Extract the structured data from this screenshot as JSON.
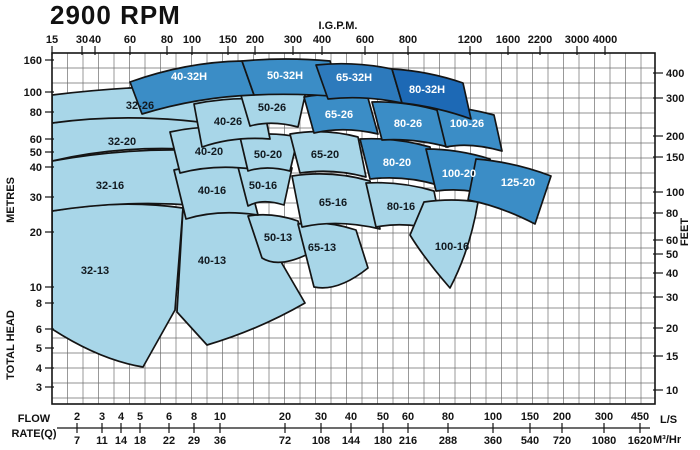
{
  "title": "2900 RPM",
  "colors": {
    "light": "#a8d6e8",
    "medium": "#3b8dc6",
    "dark": "#2d7abc",
    "darkest": "#1d69b5",
    "label_on_light": "#121a20",
    "label_on_dark": "#ffffff",
    "grid": "#6e6e6e",
    "axis": "#141414"
  },
  "axes": {
    "top": {
      "title": "I.G.P.M.",
      "ticks": [
        [
          "15",
          52
        ],
        [
          "30",
          82
        ],
        [
          "40",
          95
        ],
        [
          "60",
          130
        ],
        [
          "80",
          167
        ],
        [
          "100",
          192
        ],
        [
          "150",
          228
        ],
        [
          "200",
          255
        ],
        [
          "300",
          293
        ],
        [
          "400",
          322
        ],
        [
          "600",
          365
        ],
        [
          "800",
          408
        ],
        [
          "1200",
          470
        ],
        [
          "1600",
          508
        ],
        [
          "2200",
          540
        ],
        [
          "3000",
          577
        ],
        [
          "4000",
          605
        ]
      ]
    },
    "left": {
      "title": "METRES",
      "title2": "TOTAL HEAD",
      "ticks": [
        [
          "160",
          60
        ],
        [
          "100",
          92
        ],
        [
          "80",
          112
        ],
        [
          "60",
          139
        ],
        [
          "50",
          152
        ],
        [
          "40",
          167
        ],
        [
          "30",
          197
        ],
        [
          "20",
          232
        ],
        [
          "10",
          287
        ],
        [
          "8",
          303
        ],
        [
          "6",
          329
        ],
        [
          "5",
          348
        ],
        [
          "4",
          368
        ],
        [
          "3",
          387
        ]
      ]
    },
    "right": {
      "title": "FEET",
      "ticks": [
        [
          "400",
          73
        ],
        [
          "300",
          98
        ],
        [
          "200",
          136
        ],
        [
          "150",
          157
        ],
        [
          "100",
          192
        ],
        [
          "80",
          213
        ],
        [
          "60",
          240
        ],
        [
          "50",
          254
        ],
        [
          "40",
          273
        ],
        [
          "30",
          297
        ],
        [
          "20",
          328
        ],
        [
          "15",
          356
        ],
        [
          "10",
          390
        ]
      ]
    },
    "bottom": {
      "title_line1": "FLOW",
      "title_line2": "RATE(Q)",
      "unit1": "L/S",
      "unit2": "M³/Hr",
      "ticks": [
        [
          77,
          "2",
          "7"
        ],
        [
          102,
          "3",
          "11"
        ],
        [
          121,
          "4",
          "14"
        ],
        [
          140,
          "5",
          "18"
        ],
        [
          169,
          "6",
          "22"
        ],
        [
          194,
          "8",
          "29"
        ],
        [
          220,
          "10",
          "36"
        ],
        [
          285,
          "20",
          "72"
        ],
        [
          321,
          "30",
          "108"
        ],
        [
          351,
          "40",
          "144"
        ],
        [
          383,
          "50",
          "180"
        ],
        [
          408,
          "60",
          "216"
        ],
        [
          448,
          "80",
          "288"
        ],
        [
          493,
          "100",
          "360"
        ],
        [
          530,
          "150",
          "540"
        ],
        [
          562,
          "200",
          "720"
        ],
        [
          604,
          "300",
          "1080"
        ],
        [
          640,
          "450",
          "1620"
        ]
      ]
    }
  },
  "chart_data": {
    "type": "pump-selection-chart",
    "rpm": "2900 RPM",
    "x_units": [
      "I.G.P.M.",
      "L/S",
      "M³/Hr"
    ],
    "y_units": [
      "METRES",
      "FEET"
    ],
    "plot": {
      "x0": 52,
      "y0": 53,
      "x1": 655,
      "y1": 404,
      "grid_step_x": 15.5,
      "grid_step_y": 15
    },
    "regions": [
      {
        "label": "32-13",
        "tone": "light",
        "path": "M52,211 Q120,199 183,208 L175,310 143,367 Q100,360 52,329 Z",
        "lx": 95,
        "ly": 274
      },
      {
        "label": "40-13",
        "tone": "light",
        "path": "M183,208 Q218,202 252,212 L305,303 Q258,330 207,345 L177,312 Z",
        "lx": 212,
        "ly": 264
      },
      {
        "label": "50-13",
        "tone": "light",
        "path": "M248,216 Q272,212 298,221 L306,255 Q278,268 262,258 Z",
        "lx": 278,
        "ly": 241
      },
      {
        "label": "65-13",
        "tone": "light",
        "path": "M298,224 Q326,220 356,230 L368,268 Q338,292 314,287 Z",
        "lx": 322,
        "ly": 251
      },
      {
        "label": "32-16",
        "tone": "light",
        "path": "M52,161 Q140,145 228,152 L244,211 Q148,196 52,211 Z",
        "lx": 110,
        "ly": 189
      },
      {
        "label": "40-16",
        "tone": "light",
        "path": "M174,170 Q210,162 246,169 L258,215 Q218,209 186,219 Z",
        "lx": 212,
        "ly": 194
      },
      {
        "label": "50-16",
        "tone": "light",
        "path": "M238,167 Q264,161 292,168 L284,205 Q262,198 248,206 Z",
        "lx": 263,
        "ly": 189
      },
      {
        "label": "65-16",
        "tone": "light",
        "path": "M292,176 Q332,170 370,181 L380,229 Q338,219 302,227 Z",
        "lx": 333,
        "ly": 206
      },
      {
        "label": "80-16",
        "tone": "light",
        "path": "M366,183 Q400,181 434,191 L442,231 Q406,221 376,227 Z",
        "lx": 401,
        "ly": 210
      },
      {
        "label": "100-16",
        "tone": "light",
        "path": "M424,202 Q452,198 478,202 Q470,250 450,288 Q424,258 410,235 Z",
        "lx": 452,
        "ly": 250
      },
      {
        "label": "32-20",
        "tone": "light",
        "path": "M52,123 Q148,108 244,113 L230,153 Q138,141 52,161 Z",
        "lx": 122,
        "ly": 145
      },
      {
        "label": "40-20",
        "tone": "light",
        "path": "M170,132 Q206,124 242,129 L252,169 Q214,164 180,173 Z",
        "lx": 209,
        "ly": 155
      },
      {
        "label": "50-20",
        "tone": "light",
        "path": "M240,137 Q269,131 298,137 L290,171 Q266,165 248,171 Z",
        "lx": 268,
        "ly": 158
      },
      {
        "label": "65-20",
        "tone": "light",
        "path": "M290,134 Q324,128 358,137 L366,177 Q332,168 300,173 Z",
        "lx": 325,
        "ly": 158
      },
      {
        "label": "32-26",
        "tone": "light",
        "path": "M52,95 Q150,83 246,87 L234,127 Q140,111 52,123 Z",
        "lx": 140,
        "ly": 109
      },
      {
        "label": "40-26",
        "tone": "light",
        "path": "M194,104 Q228,97 262,99 L270,139 Q234,136 202,147 Z",
        "lx": 228,
        "ly": 125
      },
      {
        "label": "50-26",
        "tone": "light",
        "path": "M240,92 Q272,86 306,91 L298,127 Q272,120 250,126 Z",
        "lx": 272,
        "ly": 111
      },
      {
        "label": "80-20",
        "tone": "medium",
        "path": "M360,139 Q394,137 430,147 L438,185 Q404,175 370,179 Z",
        "lx": 397,
        "ly": 166
      },
      {
        "label": "100-20",
        "tone": "medium",
        "path": "M426,149 Q458,149 490,159 L498,197 Q466,187 436,191 Z",
        "lx": 459,
        "ly": 177
      },
      {
        "label": "125-20",
        "tone": "medium",
        "path": "M476,159 Q514,162 551,176 L535,224 Q500,206 468,200 Z",
        "lx": 518,
        "ly": 186
      },
      {
        "label": "65-26",
        "tone": "medium",
        "path": "M304,97 Q336,91 368,98 L378,134 Q344,126 314,133 Z",
        "lx": 339,
        "ly": 118
      },
      {
        "label": "80-26",
        "tone": "medium",
        "path": "M372,102 Q406,101 440,111 L448,147 Q414,138 382,140 Z",
        "lx": 408,
        "ly": 127
      },
      {
        "label": "100-26",
        "tone": "medium",
        "path": "M436,106 Q464,107 494,115 L502,151 Q470,142 446,147 Z",
        "lx": 467,
        "ly": 127
      },
      {
        "label": "40-32H",
        "tone": "medium",
        "path": "M130,82 Q186,62 242,61 L254,95 Q198,97 142,114 Z",
        "lx": 189,
        "ly": 80
      },
      {
        "label": "50-32H",
        "tone": "medium",
        "path": "M242,61 Q286,57 330,61 L342,97 Q298,93 254,95 Z",
        "lx": 285,
        "ly": 79
      },
      {
        "label": "65-32H",
        "tone": "dark",
        "path": "M316,65 Q354,61 392,69 L402,103 Q364,95 328,99 Z",
        "lx": 354,
        "ly": 81
      },
      {
        "label": "80-32H",
        "tone": "darkest",
        "path": "M392,69 Q428,71 463,83 L471,119 Q438,107 402,103 Z",
        "lx": 427,
        "ly": 93
      }
    ]
  }
}
